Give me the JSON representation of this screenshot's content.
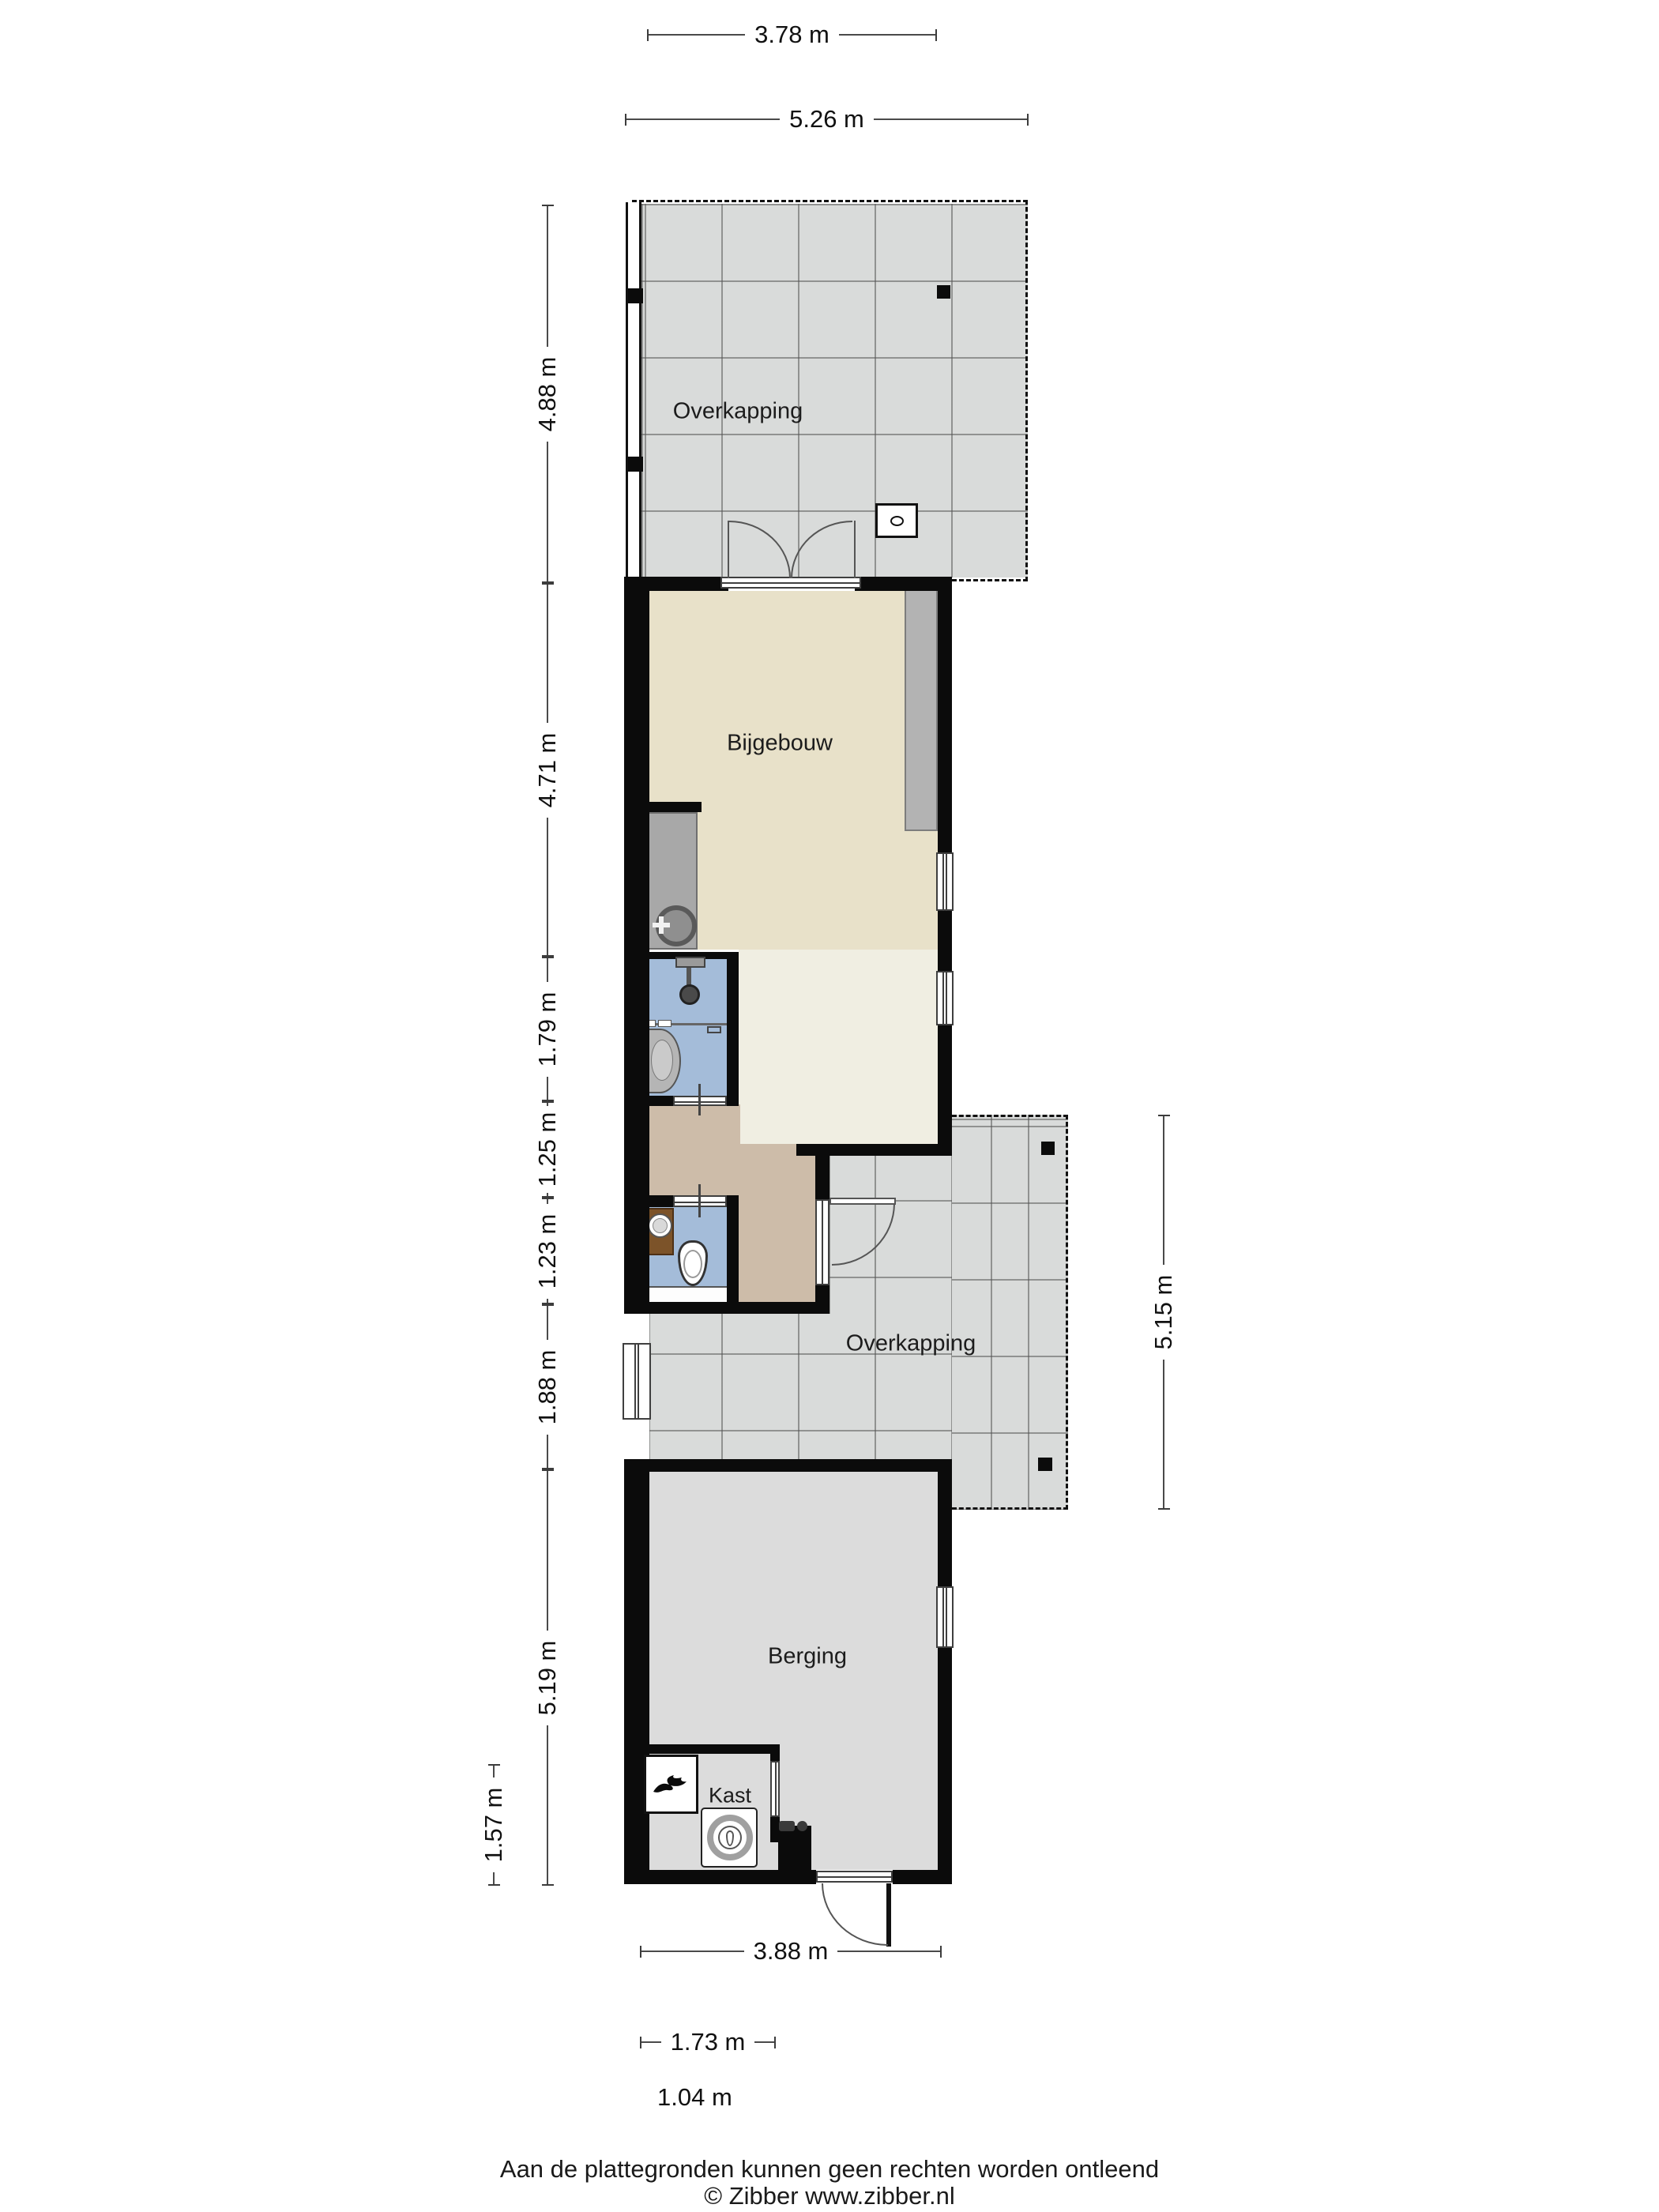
{
  "title": "Plattegrond bijgebouw",
  "rooms": {
    "overkapping_top": "Overkapping",
    "bijgebouw": "Bijgebouw",
    "overkapping_side": "Overkapping",
    "berging": "Berging",
    "kast": "Kast"
  },
  "dimensions": {
    "top": {
      "d378": "3.78 m",
      "d526": "5.26 m"
    },
    "left": {
      "d488": "4.88 m",
      "d471": "4.71 m",
      "d179": "1.79 m",
      "d125": "1.25 m",
      "d123": "1.23 m",
      "d188": "1.88 m",
      "d519": "5.19 m",
      "d157": "1.57 m"
    },
    "right": {
      "d515": "5.15 m"
    },
    "bottom": {
      "d388": "3.88 m",
      "d173": "1.73 m",
      "d104": "1.04 m"
    }
  },
  "fixtures": [
    "boiler-unit",
    "french-doors",
    "kitchen-sink",
    "shower",
    "washbasin",
    "toilet",
    "corner-basin",
    "heater",
    "washing-machine",
    "windows",
    "doors"
  ],
  "colors": {
    "wall": "#0b0b0b",
    "tile_floor": "#d9dbda",
    "bijgebouw_floor": "#e8e1c9",
    "bijgebouw_floor_light": "#f0eee2",
    "hall_floor": "#cdbca9",
    "wet_room_floor": "#a4bcd9",
    "berging_floor": "#dcdcdc",
    "counter_gray": "#a8a8a8",
    "wardrobe_gray": "#b3b3b3",
    "wood_brown": "#7c5329"
  },
  "footer": {
    "line1": "Aan de plattegronden kunnen geen rechten worden ontleend",
    "line2": "© Zibber www.zibber.nl"
  }
}
